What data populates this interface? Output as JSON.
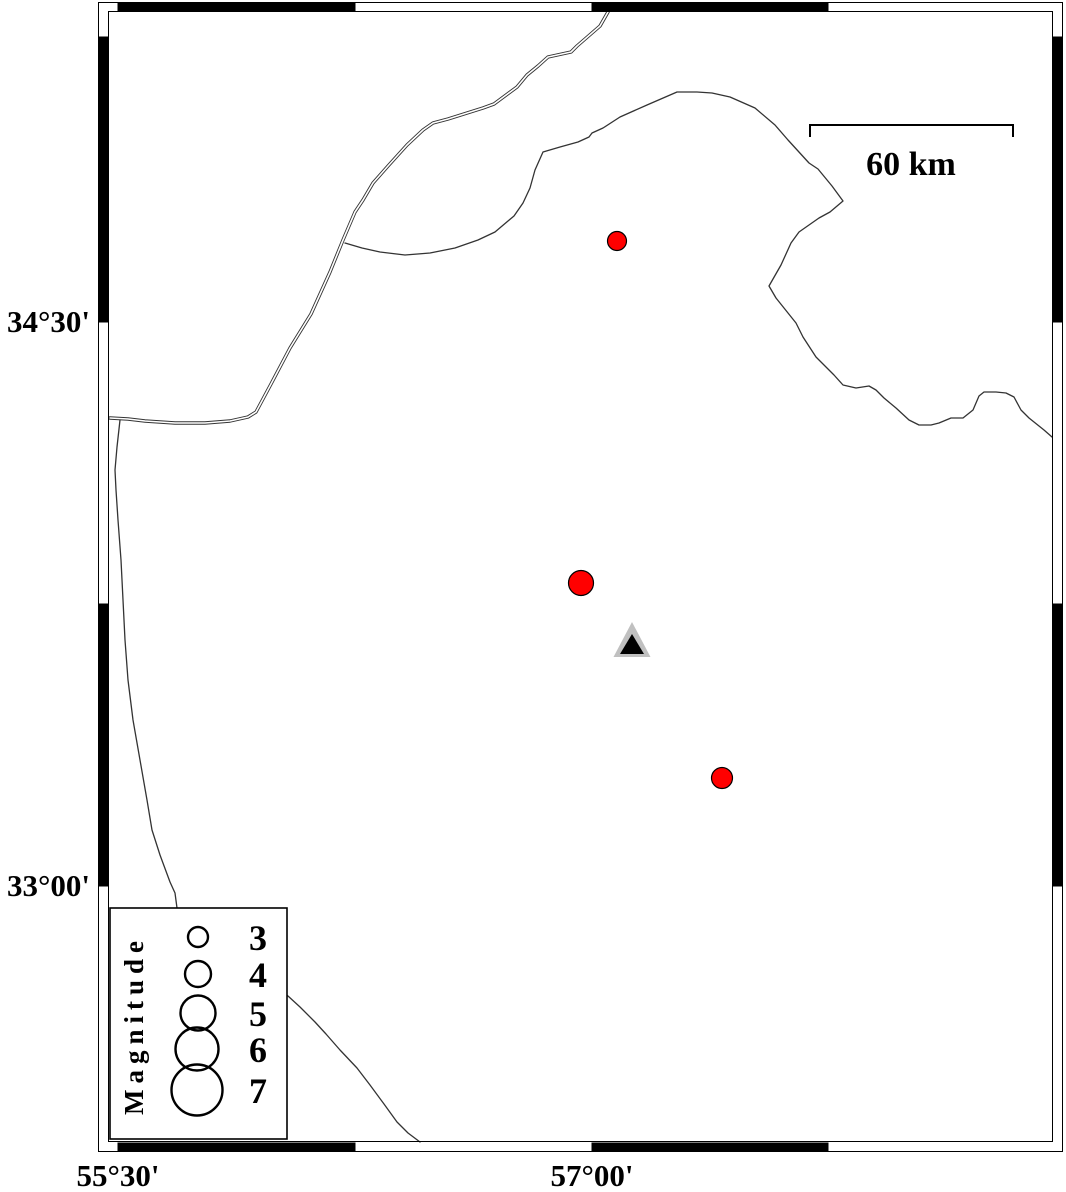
{
  "map": {
    "frame": {
      "left_labels": [
        {
          "label": "34°30'"
        },
        {
          "label": "33°00'"
        }
      ],
      "bottom_labels": [
        {
          "label": "55°30'"
        },
        {
          "label": "57°00'"
        }
      ]
    },
    "scale_bar": {
      "label": "60 km"
    },
    "legend": {
      "title": "Magnitude",
      "entries": [
        {
          "label": "3"
        },
        {
          "label": "4"
        },
        {
          "label": "5"
        },
        {
          "label": "6"
        },
        {
          "label": "7"
        }
      ]
    }
  },
  "chart_data": {
    "type": "scatter",
    "title": "",
    "projection": "geographic lon/lat map",
    "x_axis": {
      "label": "longitude",
      "ticks": [
        "55°30'",
        "57°00'"
      ],
      "tick_interval_annotated": "1°30'",
      "frame_segment_interval": "45'"
    },
    "y_axis": {
      "label": "latitude",
      "ticks": [
        "33°00'",
        "34°30'"
      ],
      "tick_interval_annotated": "1°30'",
      "frame_segment_interval": "45'"
    },
    "scale_bar_km": 60,
    "legend_magnitudes": [
      3,
      4,
      5,
      6,
      7
    ],
    "events": [
      {
        "lon_deg": 57.08,
        "lat_deg": 34.71,
        "magnitude_approx": 3.0,
        "color": "#ff0000"
      },
      {
        "lon_deg": 56.96,
        "lat_deg": 33.81,
        "magnitude_approx": 4.0,
        "color": "#ff0000"
      },
      {
        "lon_deg": 57.41,
        "lat_deg": 33.29,
        "magnitude_approx": 3.2,
        "color": "#ff0000"
      }
    ],
    "station": {
      "lon_deg": 57.13,
      "lat_deg": 33.64,
      "symbol": "triangle"
    }
  },
  "colors": {
    "event_fill": "#ff0000",
    "station_gray": "#c0c0c0",
    "boundary_line": "#333333",
    "frame": "#000000",
    "background": "#ffffff"
  }
}
